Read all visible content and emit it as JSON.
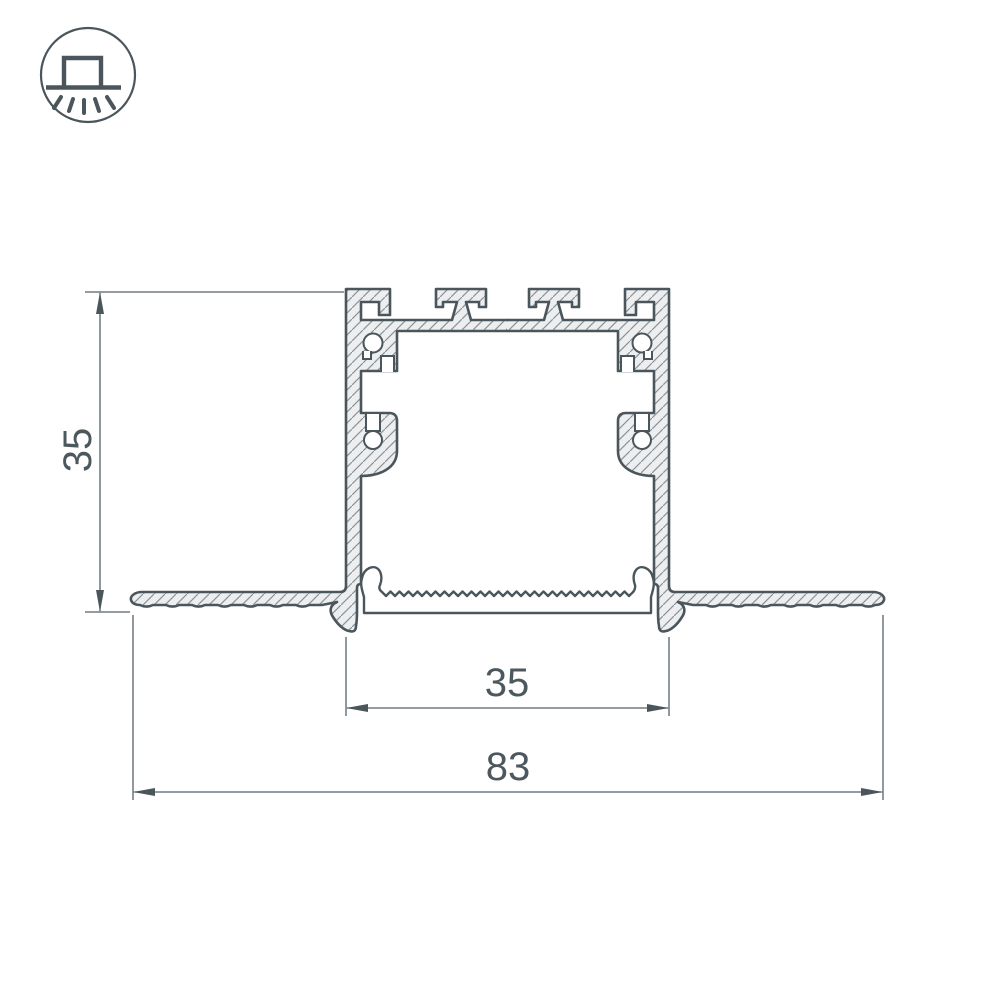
{
  "drawing": {
    "icon": {
      "name": "recessed-mount-luminaire-icon"
    },
    "dimensions": {
      "height_label": "35",
      "inner_width_label": "35",
      "overall_width_label": "83"
    },
    "values": {
      "height_mm": 35,
      "inner_width_mm": 35,
      "overall_width_mm": 83
    },
    "colors": {
      "line": "#4b565c",
      "aluminum_fill": "#eceeef",
      "hatch": "#8b9297",
      "dimension_line": "#55626a",
      "text": "#4d585e",
      "background": "#ffffff"
    }
  }
}
